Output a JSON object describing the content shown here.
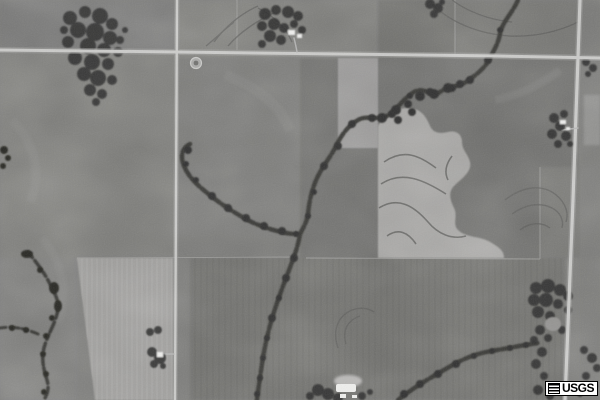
{
  "scene": {
    "kind": "grayscale USGS aerial orthophoto of farmland with crossroads, tree-lined creeks, terraced fields and farmsteads"
  },
  "watermark": {
    "label": "USGS"
  },
  "palette": {
    "base_field": "#7a7a78",
    "dark_field": "#6e6e6c",
    "mid_field": "#777775",
    "light_terraced_field": "#a5a4a2",
    "light_strip_field": "#979695",
    "bottom_light_field": "#9c9b99",
    "road": "#c8c8c6",
    "road_shoulder": "#9e9e9c",
    "trees": "#2f2f2d",
    "creek": "#383836",
    "pond": "#262624",
    "contour_line": "#5d5d5b",
    "boundary_line": "#9c9c9a",
    "buildings": "#eeeeec",
    "watermark_bg": "#ffffff",
    "watermark_text": "#000000"
  }
}
